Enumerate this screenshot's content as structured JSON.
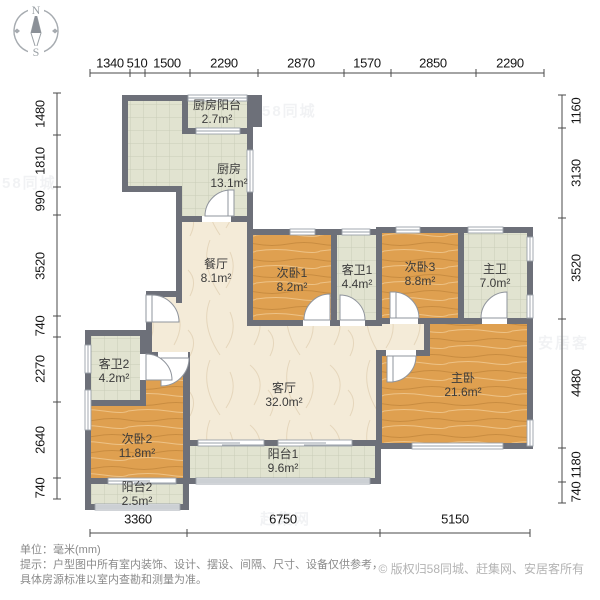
{
  "compass": {
    "north": "N",
    "south": "S"
  },
  "dimensions": {
    "unit_note": "mm",
    "top": [
      "1340",
      "510",
      "1500",
      "2290",
      "2870",
      "1570",
      "2850",
      "2290"
    ],
    "left": [
      "1480",
      "1810",
      "990",
      "3520",
      "740",
      "2270",
      "2640",
      "740"
    ],
    "right": [
      "1160",
      "3130",
      "3520",
      "4480",
      "1180",
      "740"
    ],
    "bottom": [
      "3360",
      "6750",
      "5150"
    ]
  },
  "rooms": [
    {
      "name": "厨房阳台",
      "area": "2.7m²"
    },
    {
      "name": "厨房",
      "area": "13.1m²"
    },
    {
      "name": "餐厅",
      "area": "8.1m²"
    },
    {
      "name": "次卧1",
      "area": "8.2m²"
    },
    {
      "name": "客卫1",
      "area": "4.4m²"
    },
    {
      "name": "次卧3",
      "area": "8.8m²"
    },
    {
      "name": "主卫",
      "area": "7.0m²"
    },
    {
      "name": "客厅",
      "area": "32.0m²"
    },
    {
      "name": "主卧",
      "area": "21.6m²"
    },
    {
      "name": "客卫2",
      "area": "4.2m²"
    },
    {
      "name": "次卧2",
      "area": "11.8m²"
    },
    {
      "name": "阳台1",
      "area": "9.6m²"
    },
    {
      "name": "阳台2",
      "area": "2.5m²"
    }
  ],
  "footer": {
    "unit": "单位：毫米(mm)",
    "tip_line1": "提示：户型图中所有室内装饰、设计、摆设、间隔、尺寸、设备仅供参考，",
    "tip_line2": "具体房源标准以室内查勘和测量为准。",
    "copyright": "© 版权归58同城、赶集网、安居客所有"
  },
  "watermark": {
    "brand1": "58同城",
    "brand2": "赶集网",
    "brand3": "安居客"
  },
  "colors": {
    "wall": "#6d7079",
    "wood": "#dfa050",
    "tile": "#e1e3d0",
    "marble": "#f4ebd8"
  }
}
